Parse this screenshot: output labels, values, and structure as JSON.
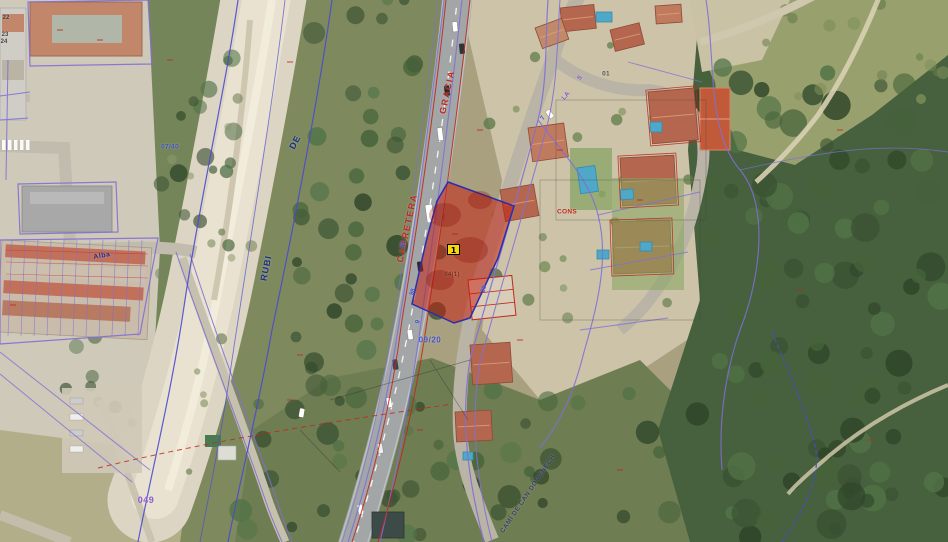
{
  "map": {
    "description": "aerial-cadastral-map",
    "marker": {
      "label": "1",
      "x": 447,
      "y": 244
    },
    "colors": {
      "parcel_fill": "#c61c10",
      "parcel_fill_opacity": 0.52,
      "parcel_border": "#2c2cae",
      "marker_bg": "#f6d70e",
      "cadastral_purple": "#7f6fd6",
      "cadastral_blue": "#4a4ad0",
      "cadastral_red": "#c0281c"
    },
    "labels": [
      {
        "t": "GRACIA",
        "x": 447,
        "y": 92,
        "r": -78,
        "c": "#c0281c",
        "s": 9,
        "ls": 1.5
      },
      {
        "t": "CARRETERA",
        "x": 407,
        "y": 228,
        "r": -78,
        "c": "#c0281c",
        "s": 9,
        "ls": 1.5
      },
      {
        "t": "DE",
        "x": 295,
        "y": 142,
        "r": -62,
        "c": "#1b2f8a",
        "s": 9,
        "ls": 1
      },
      {
        "t": "RUBI",
        "x": 266,
        "y": 268,
        "r": -78,
        "c": "#1b2f8a",
        "s": 9,
        "ls": 1
      },
      {
        "t": "Alba",
        "x": 102,
        "y": 256,
        "r": -10,
        "c": "#1b2f8a",
        "s": 7,
        "ls": 0.5
      },
      {
        "t": "09/20",
        "x": 430,
        "y": 340,
        "r": 0,
        "c": "#4553c8",
        "s": 8,
        "ls": 0.5
      },
      {
        "t": "049",
        "x": 146,
        "y": 500,
        "r": 0,
        "c": "#8a5ad0",
        "s": 9,
        "ls": 0.5
      },
      {
        "t": "07/40",
        "x": 170,
        "y": 147,
        "r": 0,
        "c": "#4553c8",
        "s": 6.5,
        "ls": 0.3
      },
      {
        "t": "CONS",
        "x": 567,
        "y": 212,
        "r": 0,
        "c": "#c0281c",
        "s": 6.5,
        "ls": 0.3
      },
      {
        "t": "01",
        "x": 606,
        "y": 74,
        "r": 0,
        "c": "#555555",
        "s": 6.5,
        "ls": 0.3
      },
      {
        "t": "CAMÍ DE CAN DOMENECH",
        "x": 528,
        "y": 494,
        "r": -56,
        "c": "#3a3f66",
        "s": 6.5,
        "ls": 0.5
      },
      {
        "t": "04(1)",
        "x": 452,
        "y": 275,
        "r": 0,
        "c": "#7a2a1a",
        "s": 6,
        "ls": 0.3
      },
      {
        "t": "20",
        "x": 484,
        "y": 289,
        "r": -72,
        "c": "#4553c8",
        "s": 6.5,
        "ls": 0
      },
      {
        "t": "LA",
        "x": 566,
        "y": 96,
        "r": -50,
        "c": "#8a5ad0",
        "s": 6.5,
        "ls": 0
      },
      {
        "t": "5",
        "x": 580,
        "y": 78,
        "r": -50,
        "c": "#8a5ad0",
        "s": 6.5,
        "ls": 0
      },
      {
        "t": "9",
        "x": 418,
        "y": 322,
        "r": -72,
        "c": "#4553c8",
        "s": 6.5,
        "ls": 0
      },
      {
        "t": "7",
        "x": 543,
        "y": 118,
        "r": -60,
        "c": "#4553c8",
        "s": 6.5,
        "ls": 0
      },
      {
        "t": "98",
        "x": 413,
        "y": 292,
        "r": -72,
        "c": "#4553c8",
        "s": 6,
        "ls": 0
      },
      {
        "t": "88",
        "x": 403,
        "y": 245,
        "r": -72,
        "c": "#4553c8",
        "s": 6,
        "ls": 0
      },
      {
        "t": "22",
        "x": 6,
        "y": 18,
        "r": 0,
        "c": "#444444",
        "s": 6,
        "ls": 0
      },
      {
        "t": "23",
        "x": 5,
        "y": 35,
        "r": 0,
        "c": "#444444",
        "s": 6,
        "ls": 0
      },
      {
        "t": "24",
        "x": 4,
        "y": 42,
        "r": 0,
        "c": "#444444",
        "s": 6,
        "ls": 0
      }
    ]
  }
}
